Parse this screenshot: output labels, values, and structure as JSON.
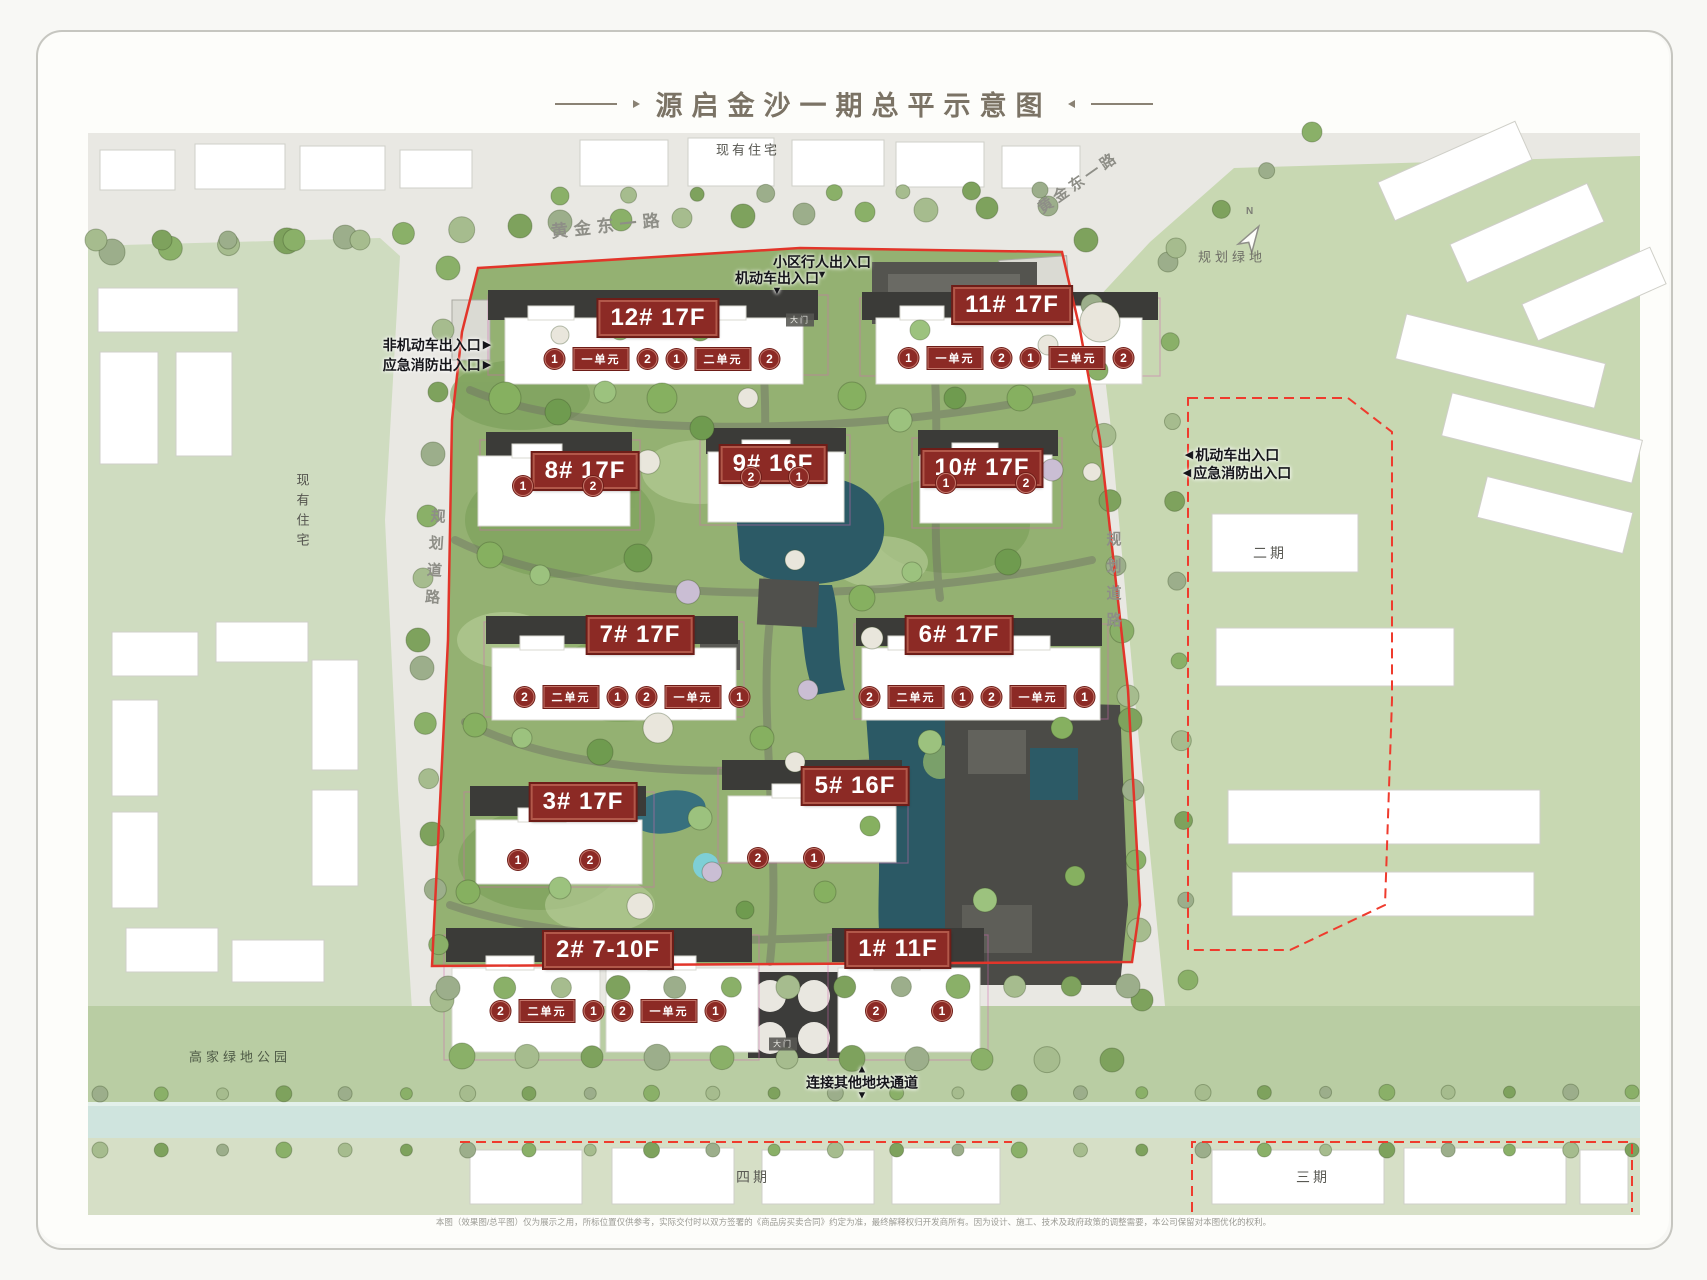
{
  "title": {
    "text": "源启金沙一期总平示意图"
  },
  "compass": {
    "label": "N"
  },
  "areas": {
    "existing_top": "现有住宅",
    "existing_left": "现有住宅",
    "road_gold_east_left": "黄金东一路",
    "road_gold_east_right": "黄金东一路",
    "planned_green": "规划绿地",
    "planned_road_left": "规划道路",
    "planned_road_right": "规划道路",
    "phase2": "二期",
    "phase3": "三期",
    "phase4": "四期",
    "gaojia_park": "高家绿地公园"
  },
  "entrances": {
    "pedestrian_top": "小区行人出入口",
    "vehicle_top": "机动车出入口",
    "non_motor_left": "非机动车出入口",
    "fire_left": "应急消防出入口",
    "vehicle_right": "机动车出入口",
    "fire_right": "应急消防出入口",
    "connect_bottom": "连接其他地块通道"
  },
  "gates": {
    "north": "大门",
    "south": "大门"
  },
  "buildings": {
    "b12": {
      "badge": "12# 17F",
      "units": [
        "1",
        "一单元",
        "2",
        "1",
        "二单元",
        "2"
      ]
    },
    "b11": {
      "badge": "11# 17F",
      "units": [
        "1",
        "一单元",
        "2",
        "1",
        "二单元",
        "2"
      ]
    },
    "b8": {
      "badge": "8# 17F",
      "units": [
        "1",
        "2"
      ]
    },
    "b9": {
      "badge": "9# 16F",
      "units": [
        "2",
        "1"
      ]
    },
    "b10": {
      "badge": "10# 17F",
      "units": [
        "1",
        "2"
      ]
    },
    "b7": {
      "badge": "7# 17F",
      "units": [
        "2",
        "二单元",
        "1",
        "2",
        "一单元",
        "1"
      ]
    },
    "b6": {
      "badge": "6# 17F",
      "units": [
        "2",
        "二单元",
        "1",
        "2",
        "一单元",
        "1"
      ]
    },
    "b5": {
      "badge": "5# 16F",
      "units": [
        "2",
        "1"
      ]
    },
    "b3": {
      "badge": "3# 17F",
      "units": [
        "1",
        "2"
      ]
    },
    "b2": {
      "badge": "2# 7-10F",
      "units": [
        "2",
        "二单元",
        "1",
        "2",
        "一单元",
        "1"
      ]
    },
    "b1": {
      "badge": "1# 11F",
      "units": [
        "2",
        "1"
      ]
    }
  },
  "disclaimer": {
    "text": "本图（效果图/总平图）仅为展示之用，所标位置仅供参考，实际交付时以双方签署的《商品房买卖合同》约定为准，最终解释权归开发商所有。因为设计、施工、技术及政府政策的调整需要，本公司保留对本图优化的权利。"
  },
  "colors": {
    "badge_bg": "#8c2a25",
    "boundary_red": "#e2352a",
    "dashed_red": "#ef3b2d",
    "water": "#2c5a66"
  }
}
